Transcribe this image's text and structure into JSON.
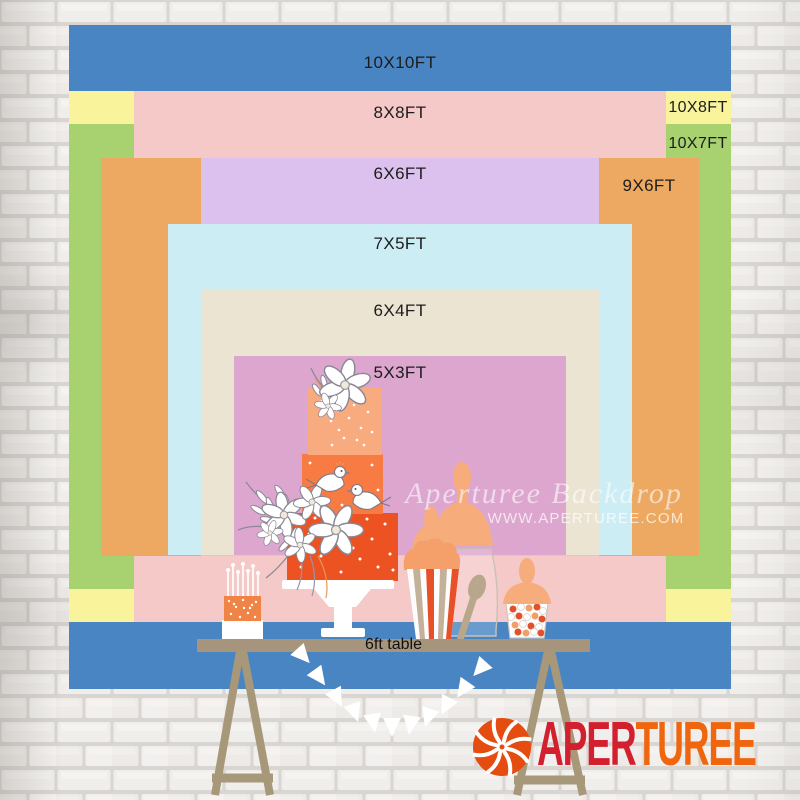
{
  "backdrop": {
    "sizes": [
      {
        "id": "10x10",
        "label": "10X10FT",
        "color": "#4a85c3"
      },
      {
        "id": "10x8",
        "label": "10X8FT",
        "color": "#f9f49c"
      },
      {
        "id": "10x7",
        "label": "10X7FT",
        "color": "#a8d170"
      },
      {
        "id": "8x8",
        "label": "8X8FT",
        "color": "#f4c9c8"
      },
      {
        "id": "9x6",
        "label": "9X6FT",
        "color": "#eda961"
      },
      {
        "id": "6x6",
        "label": "6X6FT",
        "color": "#dcc0ee"
      },
      {
        "id": "7x5",
        "label": "7X5FT",
        "color": "#cdedf4"
      },
      {
        "id": "6x4",
        "label": "6X4FT",
        "color": "#ece4d2"
      },
      {
        "id": "5x3",
        "label": "5X3FT",
        "color": "#dda6cf"
      }
    ]
  },
  "table": {
    "label": "6ft table",
    "color": "#a6957c"
  },
  "watermark": {
    "line1": "Aperturee Backdrop",
    "line2": "WWW.APERTUREE.COM"
  },
  "logo": {
    "text_primary": "APER",
    "text_secondary": "TUREE",
    "primary_color": "#d2202f",
    "secondary_color": "#ef660e",
    "icon": "aperture-shutter-icon",
    "icon_color": "#e54c10"
  }
}
